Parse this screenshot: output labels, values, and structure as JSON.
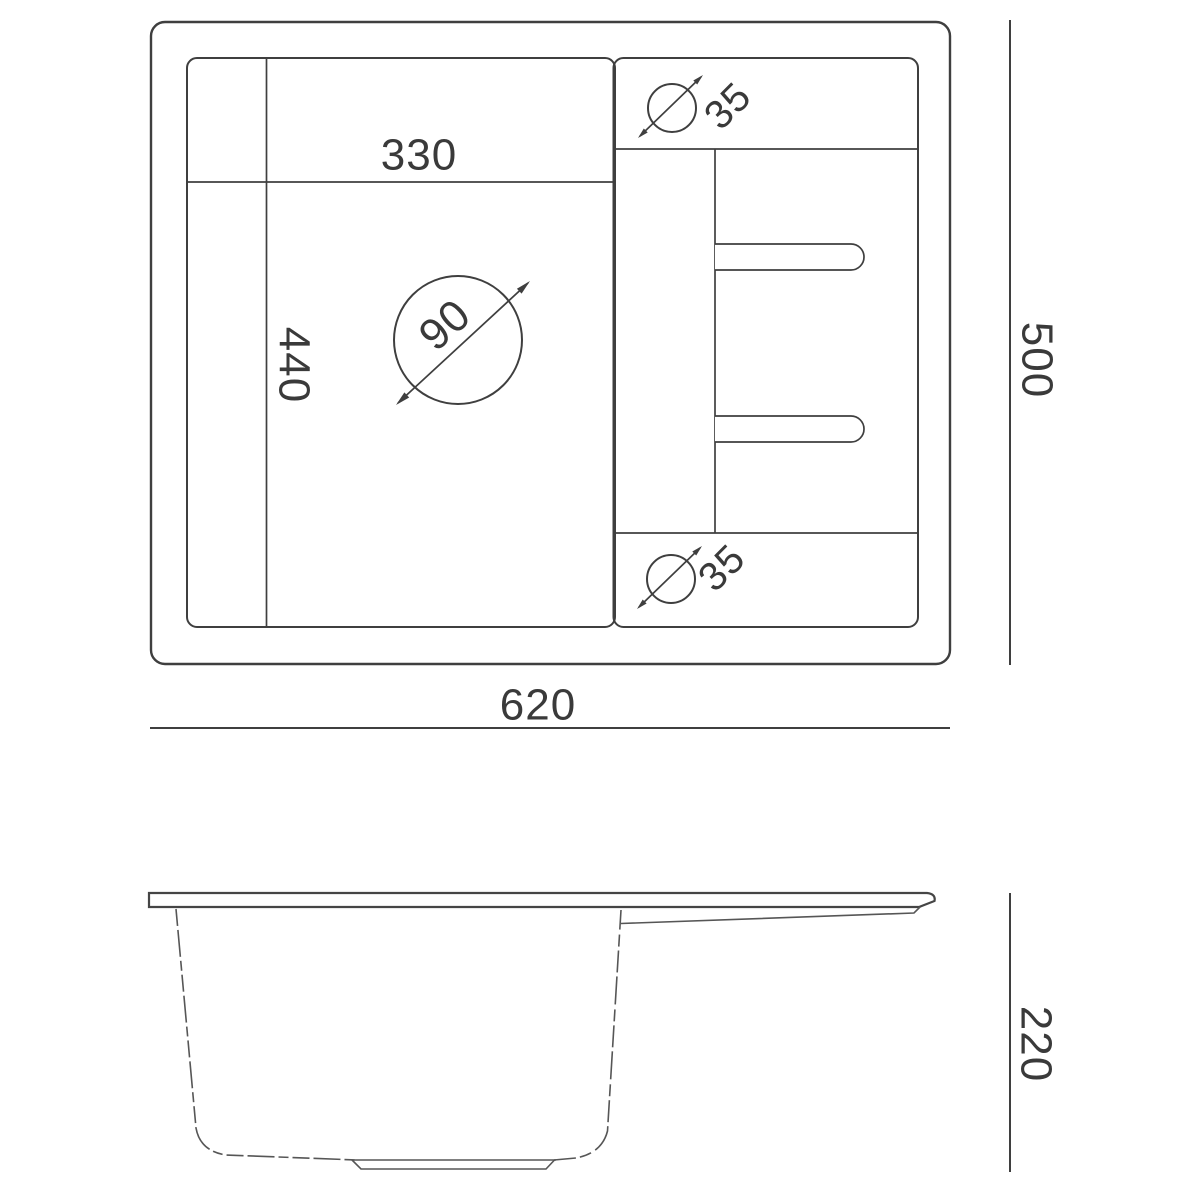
{
  "page": {
    "background": "#ffffff"
  },
  "drawing": {
    "type": "technical-drawing",
    "subject": "kitchen-sink-dimension-diagram",
    "views": {
      "top_view": {
        "overall_width": "620",
        "overall_depth": "500",
        "bowl_width": "330",
        "bowl_depth": "440",
        "drain_diameter": "90",
        "tap_hole_top_diameter": "35",
        "tap_hole_bottom_diameter": "35"
      },
      "side_view": {
        "bowl_height": "220"
      }
    },
    "colors": {
      "line": "#3f3f3f",
      "side_line": "#565656",
      "background": "#ffffff"
    }
  }
}
